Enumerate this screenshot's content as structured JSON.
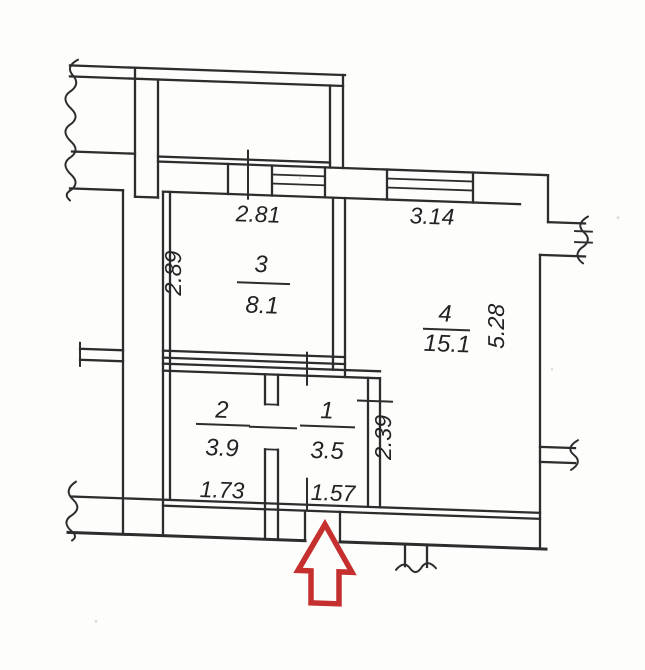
{
  "plan": {
    "rooms": {
      "room1": {
        "number": "1",
        "area": "3.5"
      },
      "room2": {
        "number": "2",
        "area": "3.9"
      },
      "room3": {
        "number": "3",
        "area": "8.1"
      },
      "room4": {
        "number": "4",
        "area": "15.1"
      }
    },
    "dimensions": {
      "room3_width_top": "2.81",
      "room3_height_left": "2.89",
      "room4_width_top": "3.14",
      "room4_height_right": "5.28",
      "room1_height_right": "2.39",
      "room2_width_bottom": "1.73",
      "room1_width_bottom": "1.57"
    },
    "entrance_arrow": {
      "direction": "up",
      "color": "#c5302f"
    },
    "colors": {
      "ink": "#2d2d2d",
      "paper": "#fdfdfc"
    }
  }
}
